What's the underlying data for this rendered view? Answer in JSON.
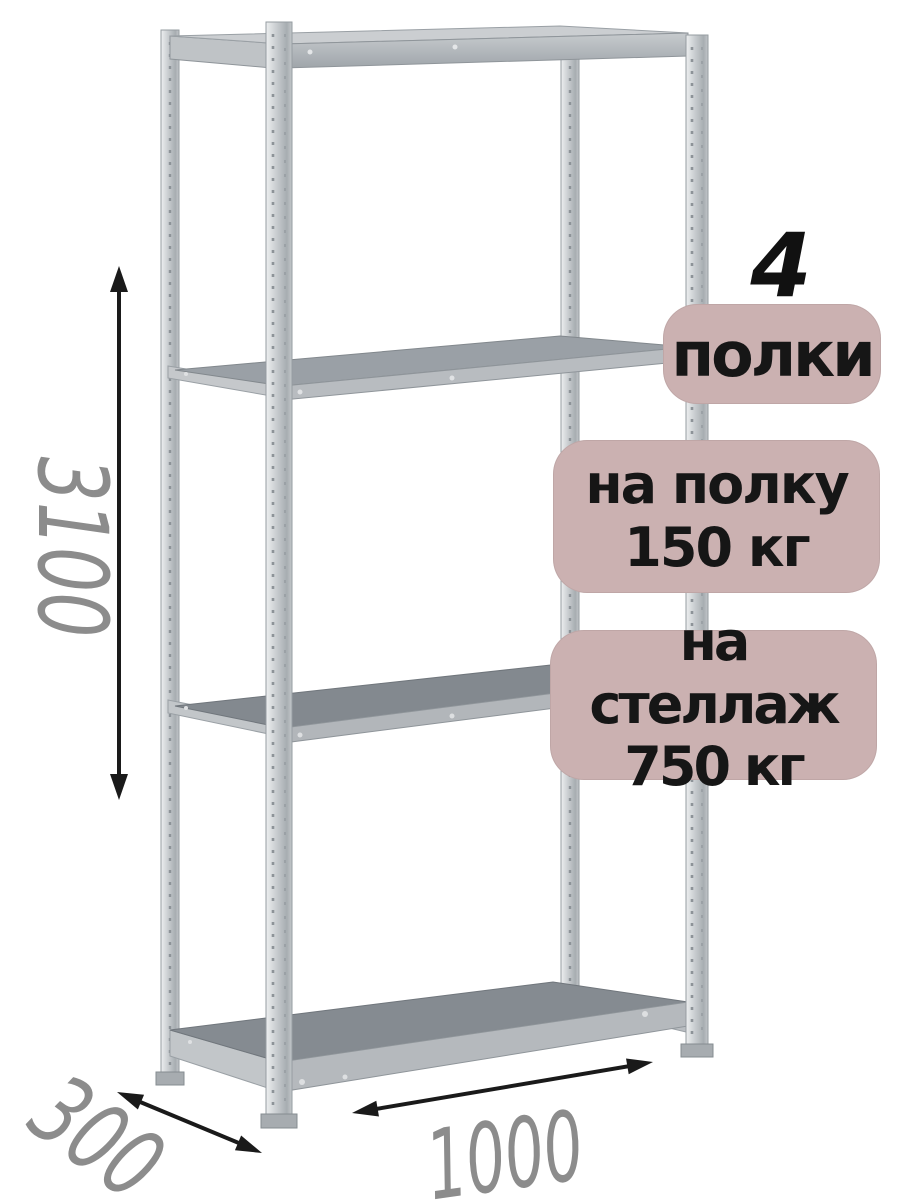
{
  "shelf_count": "4",
  "badges": {
    "shelves": {
      "label": "полки"
    },
    "per_shelf": {
      "line1": "на полку",
      "line2": "150 кг"
    },
    "per_rack": {
      "line1": "на стеллаж",
      "line2": "750 кг"
    }
  },
  "dimensions": {
    "height": "3100",
    "width": "1000",
    "depth": "300"
  },
  "colors": {
    "badge_bg": "#cbb1b1",
    "badge_text": "#161616",
    "accent_number": "#111111",
    "dimension_text": "#8c8c8c",
    "arrow": "#1a1a1a"
  }
}
